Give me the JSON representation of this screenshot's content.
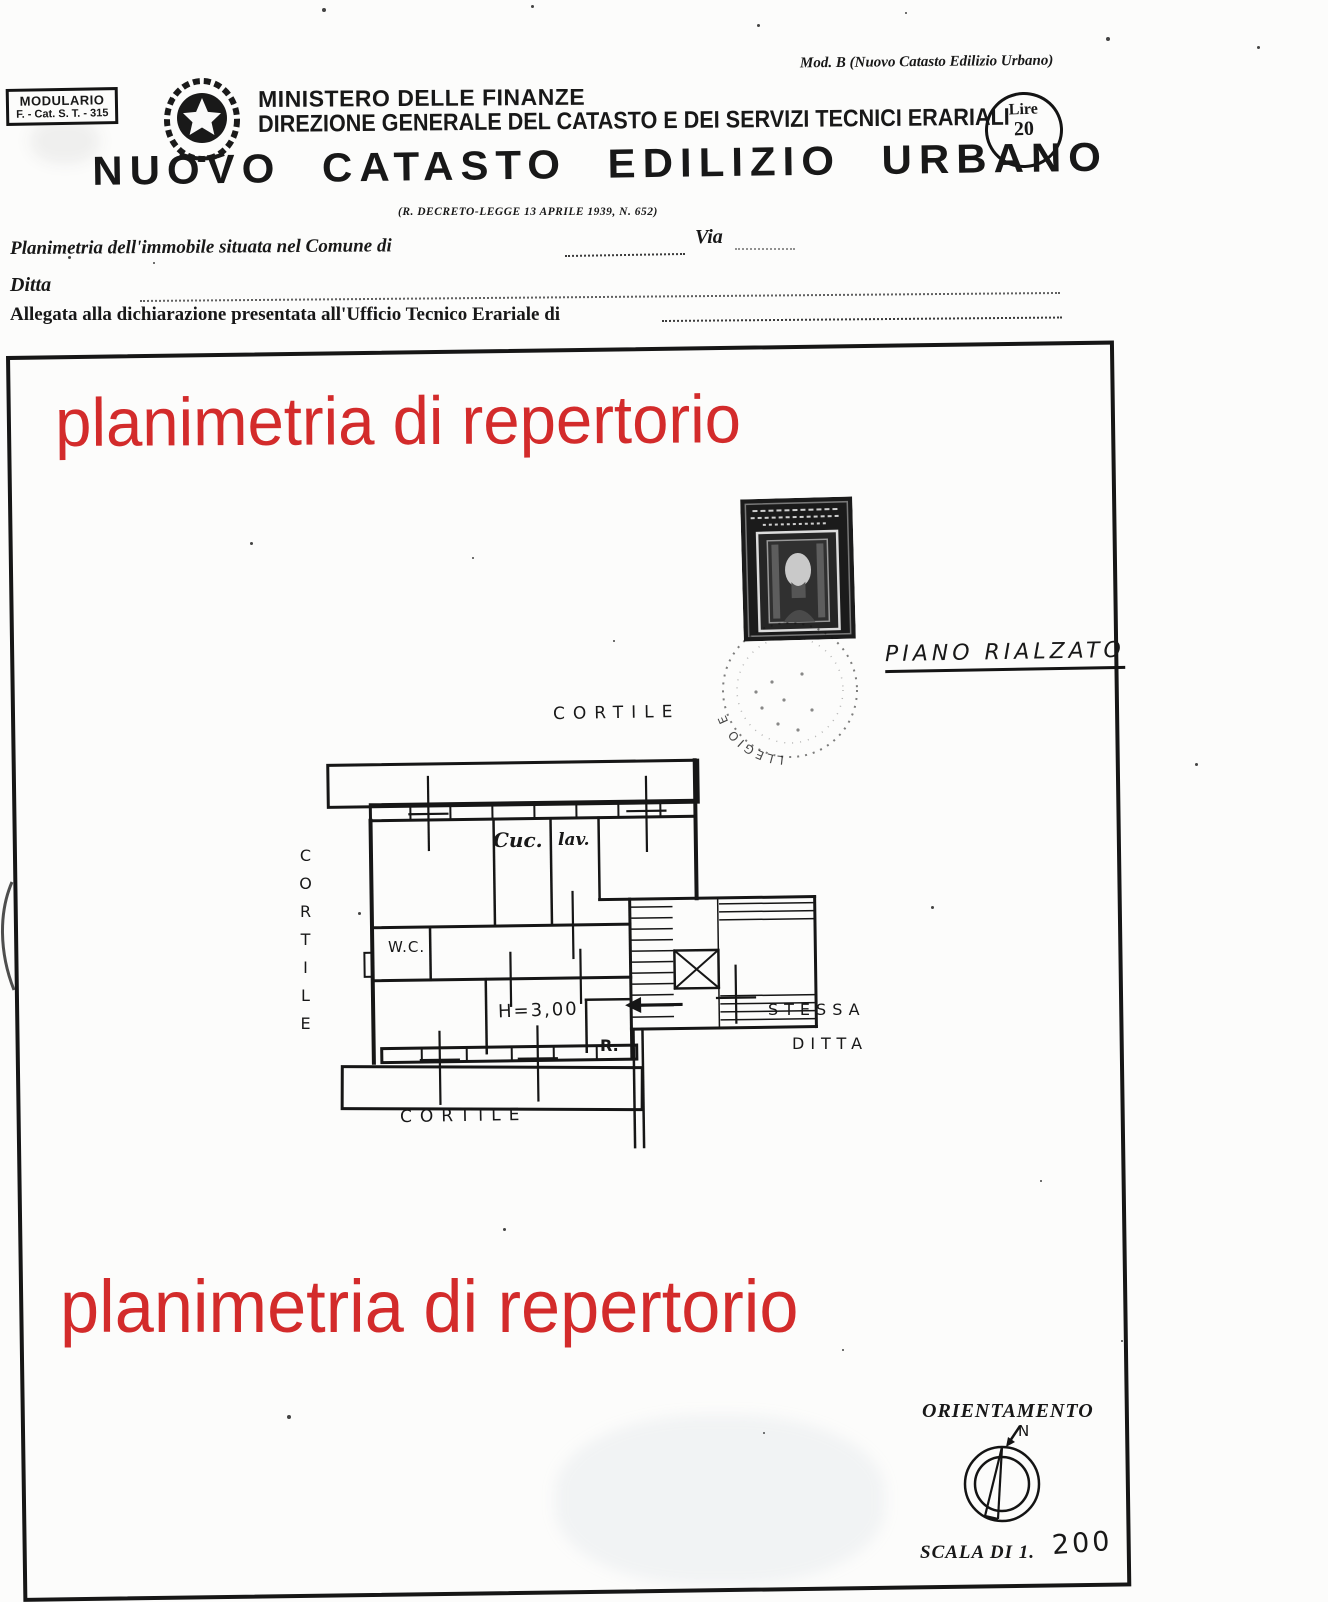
{
  "document": {
    "modulario": {
      "line1": "MODULARIO",
      "line2": "F. - Cat. S. T. - 315"
    },
    "mod_b_note": "Mod. B (Nuovo Catasto Edilizio Urbano)",
    "ministry": "MINISTERO DELLE FINANZE",
    "directorate": "DIREZIONE GENERALE DEL CATASTO E DEI SERVIZI TECNICI ERARIALI",
    "title": "NUOVO CATASTO EDILIZIO URBANO",
    "decree_note": "(R. DECRETO-LEGGE 13 APRILE 1939, N. 652)",
    "fee_stamp": {
      "label": "Lire",
      "value": "20"
    }
  },
  "form": {
    "line1_label": "Planimetria dell'immobile situata nel Comune di",
    "via_label": "Via",
    "line2_label": "Ditta",
    "line3_label": "Allegata alla dichiarazione presentata all'Ufficio Tecnico Erariale di"
  },
  "watermark": {
    "text": "planimetria di repertorio",
    "color": "#d32b2b"
  },
  "plan": {
    "floor_label": "PIANO RIALZATO",
    "cortile_top": "CORTILE",
    "cortile_left": "CORTILE",
    "cortile_bottom": "CORTILE",
    "rooms": {
      "kitchen": "Cuc.",
      "laundry": "lav.",
      "wc": "W.C.",
      "height": "H=3,00",
      "closet": "R."
    },
    "same_owner_line1": "STESSA",
    "same_owner_line2": "DITTA"
  },
  "postmark_text": "LLEGIO E",
  "footer": {
    "orientation_label": "ORIENTAMENTO",
    "north_label": "N",
    "scale_label": "SCALA DI 1.",
    "scale_value": "200"
  }
}
